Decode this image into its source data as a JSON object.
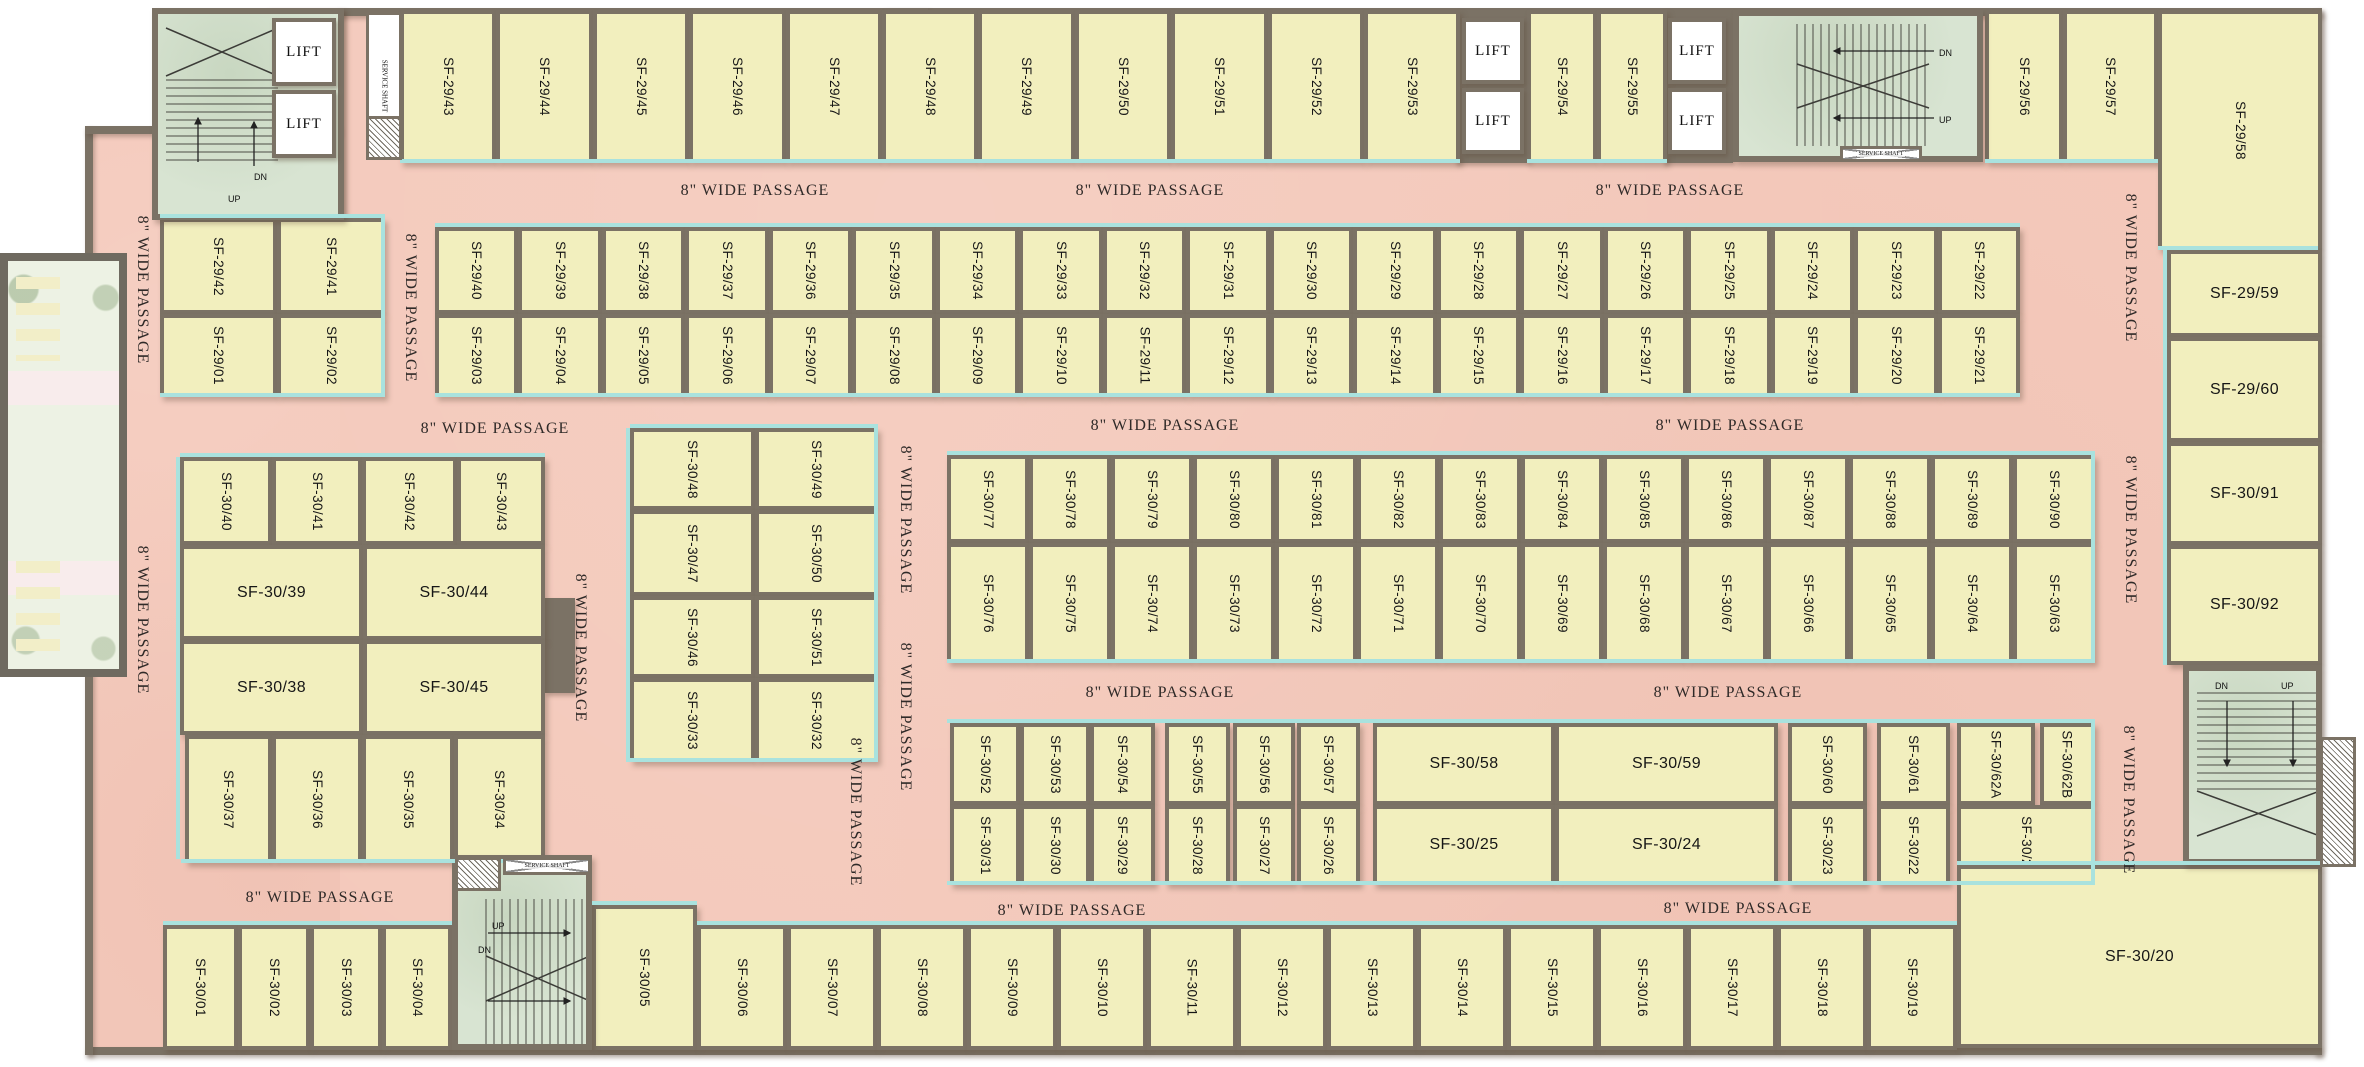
{
  "title": "Second Floor Shop Layout Plan",
  "passage_label": "8\" WIDE PASSAGE",
  "lift_label": "LIFT",
  "stair_up": "UP",
  "stair_dn": "DN",
  "service_shaft_label": "SERVICE SHAFT",
  "fire_shaft_label": "FIRE SHAFT",
  "colors": {
    "wall": "#7b7265",
    "unit_fill": "#f2efbe",
    "passage_fill": "#f4c9bb",
    "storefront": "#a9e2de",
    "stair_fill": "#d8e4d2",
    "label_text": "#161616"
  },
  "lifts": [
    {
      "x": 272,
      "y": 18,
      "w": 64,
      "h": 68
    },
    {
      "x": 272,
      "y": 90,
      "w": 64,
      "h": 68
    },
    {
      "x": 1462,
      "y": 18,
      "w": 62,
      "h": 66
    },
    {
      "x": 1462,
      "y": 88,
      "w": 62,
      "h": 66
    },
    {
      "x": 1668,
      "y": 18,
      "w": 58,
      "h": 66
    },
    {
      "x": 1668,
      "y": 88,
      "w": 58,
      "h": 66
    }
  ],
  "passage_labels": [
    {
      "x": 755,
      "y": 191,
      "o": "h"
    },
    {
      "x": 1150,
      "y": 191,
      "o": "h"
    },
    {
      "x": 1670,
      "y": 191,
      "o": "h"
    },
    {
      "x": 495,
      "y": 429,
      "o": "h"
    },
    {
      "x": 1165,
      "y": 426,
      "o": "h"
    },
    {
      "x": 1730,
      "y": 426,
      "o": "h"
    },
    {
      "x": 1160,
      "y": 693,
      "o": "h"
    },
    {
      "x": 1728,
      "y": 693,
      "o": "h"
    },
    {
      "x": 320,
      "y": 898,
      "o": "h"
    },
    {
      "x": 1072,
      "y": 911,
      "o": "h"
    },
    {
      "x": 1738,
      "y": 909,
      "o": "h"
    },
    {
      "x": 142,
      "y": 290,
      "o": "v"
    },
    {
      "x": 142,
      "y": 620,
      "o": "v"
    },
    {
      "x": 410,
      "y": 308,
      "o": "v"
    },
    {
      "x": 580,
      "y": 648,
      "o": "v"
    },
    {
      "x": 905,
      "y": 520,
      "o": "v"
    },
    {
      "x": 905,
      "y": 717,
      "o": "v"
    },
    {
      "x": 855,
      "y": 812,
      "o": "v"
    },
    {
      "x": 2130,
      "y": 268,
      "o": "v"
    },
    {
      "x": 2130,
      "y": 530,
      "o": "v"
    },
    {
      "x": 2128,
      "y": 800,
      "o": "v"
    }
  ],
  "rooms": [
    {
      "l": "SF-29/43",
      "x": 400,
      "y": 10,
      "w": 96,
      "h": 153,
      "o": "v"
    },
    {
      "l": "SF-29/44",
      "x": 496,
      "y": 10,
      "w": 97,
      "h": 153,
      "o": "v"
    },
    {
      "l": "SF-29/45",
      "x": 593,
      "y": 10,
      "w": 96,
      "h": 153,
      "o": "v"
    },
    {
      "l": "SF-29/46",
      "x": 689,
      "y": 10,
      "w": 97,
      "h": 153,
      "o": "v"
    },
    {
      "l": "SF-29/47",
      "x": 786,
      "y": 10,
      "w": 96,
      "h": 153,
      "o": "v"
    },
    {
      "l": "SF-29/48",
      "x": 882,
      "y": 10,
      "w": 96,
      "h": 153,
      "o": "v"
    },
    {
      "l": "SF-29/49",
      "x": 978,
      "y": 10,
      "w": 97,
      "h": 153,
      "o": "v"
    },
    {
      "l": "SF-29/50",
      "x": 1075,
      "y": 10,
      "w": 96,
      "h": 153,
      "o": "v"
    },
    {
      "l": "SF-29/51",
      "x": 1171,
      "y": 10,
      "w": 97,
      "h": 153,
      "o": "v"
    },
    {
      "l": "SF-29/52",
      "x": 1268,
      "y": 10,
      "w": 96,
      "h": 153,
      "o": "v"
    },
    {
      "l": "SF-29/53",
      "x": 1364,
      "y": 10,
      "w": 96,
      "h": 153,
      "o": "v"
    },
    {
      "l": "SF-29/54",
      "x": 1527,
      "y": 10,
      "w": 70,
      "h": 153,
      "o": "v"
    },
    {
      "l": "SF-29/55",
      "x": 1597,
      "y": 10,
      "w": 70,
      "h": 153,
      "o": "v"
    },
    {
      "l": "SF-29/56",
      "x": 1985,
      "y": 10,
      "w": 78,
      "h": 153,
      "o": "v"
    },
    {
      "l": "SF-29/57",
      "x": 2063,
      "y": 10,
      "w": 95,
      "h": 153,
      "o": "v"
    },
    {
      "l": "SF-29/58",
      "x": 2158,
      "y": 10,
      "w": 164,
      "h": 240,
      "o": "v"
    },
    {
      "l": "SF-29/42",
      "x": 160,
      "y": 218,
      "w": 117,
      "h": 96,
      "o": "v"
    },
    {
      "l": "SF-29/41",
      "x": 277,
      "y": 218,
      "w": 108,
      "h": 96,
      "o": "v"
    },
    {
      "l": "SF-29/01",
      "x": 160,
      "y": 314,
      "w": 117,
      "h": 83,
      "o": "v"
    },
    {
      "l": "SF-29/02",
      "x": 277,
      "y": 314,
      "w": 108,
      "h": 83,
      "o": "v"
    },
    {
      "l": "SF-29/40",
      "x": 435,
      "y": 227,
      "w": 83,
      "h": 87,
      "o": "v"
    },
    {
      "l": "SF-29/39",
      "x": 518,
      "y": 227,
      "w": 84,
      "h": 87,
      "o": "v"
    },
    {
      "l": "SF-29/38",
      "x": 602,
      "y": 227,
      "w": 83,
      "h": 87,
      "o": "v"
    },
    {
      "l": "SF-29/37",
      "x": 685,
      "y": 227,
      "w": 84,
      "h": 87,
      "o": "v"
    },
    {
      "l": "SF-29/36",
      "x": 769,
      "y": 227,
      "w": 83,
      "h": 87,
      "o": "v"
    },
    {
      "l": "SF-29/35",
      "x": 852,
      "y": 227,
      "w": 84,
      "h": 87,
      "o": "v"
    },
    {
      "l": "SF-29/34",
      "x": 936,
      "y": 227,
      "w": 83,
      "h": 87,
      "o": "v"
    },
    {
      "l": "SF-29/33",
      "x": 1019,
      "y": 227,
      "w": 84,
      "h": 87,
      "o": "v"
    },
    {
      "l": "SF-29/32",
      "x": 1103,
      "y": 227,
      "w": 83,
      "h": 87,
      "o": "v"
    },
    {
      "l": "SF-29/31",
      "x": 1186,
      "y": 227,
      "w": 84,
      "h": 87,
      "o": "v"
    },
    {
      "l": "SF-29/30",
      "x": 1270,
      "y": 227,
      "w": 83,
      "h": 87,
      "o": "v"
    },
    {
      "l": "SF-29/29",
      "x": 1353,
      "y": 227,
      "w": 84,
      "h": 87,
      "o": "v"
    },
    {
      "l": "SF-29/28",
      "x": 1437,
      "y": 227,
      "w": 83,
      "h": 87,
      "o": "v"
    },
    {
      "l": "SF-29/27",
      "x": 1520,
      "y": 227,
      "w": 84,
      "h": 87,
      "o": "v"
    },
    {
      "l": "SF-29/26",
      "x": 1604,
      "y": 227,
      "w": 83,
      "h": 87,
      "o": "v"
    },
    {
      "l": "SF-29/25",
      "x": 1687,
      "y": 227,
      "w": 84,
      "h": 87,
      "o": "v"
    },
    {
      "l": "SF-29/24",
      "x": 1771,
      "y": 227,
      "w": 83,
      "h": 87,
      "o": "v"
    },
    {
      "l": "SF-29/23",
      "x": 1854,
      "y": 227,
      "w": 84,
      "h": 87,
      "o": "v"
    },
    {
      "l": "SF-29/22",
      "x": 1938,
      "y": 227,
      "w": 82,
      "h": 87,
      "o": "v"
    },
    {
      "l": "SF-29/03",
      "x": 435,
      "y": 314,
      "w": 83,
      "h": 83,
      "o": "v"
    },
    {
      "l": "SF-29/04",
      "x": 518,
      "y": 314,
      "w": 84,
      "h": 83,
      "o": "v"
    },
    {
      "l": "SF-29/05",
      "x": 602,
      "y": 314,
      "w": 83,
      "h": 83,
      "o": "v"
    },
    {
      "l": "SF-29/06",
      "x": 685,
      "y": 314,
      "w": 84,
      "h": 83,
      "o": "v"
    },
    {
      "l": "SF-29/07",
      "x": 769,
      "y": 314,
      "w": 83,
      "h": 83,
      "o": "v"
    },
    {
      "l": "SF-29/08",
      "x": 852,
      "y": 314,
      "w": 84,
      "h": 83,
      "o": "v"
    },
    {
      "l": "SF-29/09",
      "x": 936,
      "y": 314,
      "w": 83,
      "h": 83,
      "o": "v"
    },
    {
      "l": "SF-29/10",
      "x": 1019,
      "y": 314,
      "w": 84,
      "h": 83,
      "o": "v"
    },
    {
      "l": "SF-29/11",
      "x": 1103,
      "y": 314,
      "w": 83,
      "h": 83,
      "o": "v"
    },
    {
      "l": "SF-29/12",
      "x": 1186,
      "y": 314,
      "w": 84,
      "h": 83,
      "o": "v"
    },
    {
      "l": "SF-29/13",
      "x": 1270,
      "y": 314,
      "w": 83,
      "h": 83,
      "o": "v"
    },
    {
      "l": "SF-29/14",
      "x": 1353,
      "y": 314,
      "w": 84,
      "h": 83,
      "o": "v"
    },
    {
      "l": "SF-29/15",
      "x": 1437,
      "y": 314,
      "w": 83,
      "h": 83,
      "o": "v"
    },
    {
      "l": "SF-29/16",
      "x": 1520,
      "y": 314,
      "w": 84,
      "h": 83,
      "o": "v"
    },
    {
      "l": "SF-29/17",
      "x": 1604,
      "y": 314,
      "w": 83,
      "h": 83,
      "o": "v"
    },
    {
      "l": "SF-29/18",
      "x": 1687,
      "y": 314,
      "w": 84,
      "h": 83,
      "o": "v"
    },
    {
      "l": "SF-29/19",
      "x": 1771,
      "y": 314,
      "w": 83,
      "h": 83,
      "o": "v"
    },
    {
      "l": "SF-29/20",
      "x": 1854,
      "y": 314,
      "w": 84,
      "h": 83,
      "o": "v"
    },
    {
      "l": "SF-29/21",
      "x": 1938,
      "y": 314,
      "w": 82,
      "h": 83,
      "o": "v"
    },
    {
      "l": "SF-29/59",
      "x": 2167,
      "y": 250,
      "w": 155,
      "h": 87,
      "o": "h"
    },
    {
      "l": "SF-29/60",
      "x": 2167,
      "y": 337,
      "w": 155,
      "h": 105,
      "o": "h"
    },
    {
      "l": "SF-30/91",
      "x": 2167,
      "y": 442,
      "w": 155,
      "h": 103,
      "o": "h"
    },
    {
      "l": "SF-30/92",
      "x": 2167,
      "y": 545,
      "w": 155,
      "h": 120,
      "o": "h"
    },
    {
      "l": "SF-30/40",
      "x": 180,
      "y": 457,
      "w": 92,
      "h": 88,
      "o": "v"
    },
    {
      "l": "SF-30/41",
      "x": 272,
      "y": 457,
      "w": 90,
      "h": 88,
      "o": "v"
    },
    {
      "l": "SF-30/42",
      "x": 362,
      "y": 457,
      "w": 95,
      "h": 88,
      "o": "v"
    },
    {
      "l": "SF-30/43",
      "x": 457,
      "y": 457,
      "w": 88,
      "h": 88,
      "o": "v"
    },
    {
      "l": "SF-30/39",
      "x": 180,
      "y": 545,
      "w": 183,
      "h": 95,
      "o": "h"
    },
    {
      "l": "SF-30/44",
      "x": 363,
      "y": 545,
      "w": 182,
      "h": 95,
      "o": "h"
    },
    {
      "l": "SF-30/38",
      "x": 180,
      "y": 640,
      "w": 183,
      "h": 95,
      "o": "h"
    },
    {
      "l": "SF-30/45",
      "x": 363,
      "y": 640,
      "w": 182,
      "h": 95,
      "o": "h"
    },
    {
      "l": "SF-30/37",
      "x": 185,
      "y": 735,
      "w": 87,
      "h": 128,
      "o": "v"
    },
    {
      "l": "SF-30/36",
      "x": 272,
      "y": 735,
      "w": 90,
      "h": 128,
      "o": "v"
    },
    {
      "l": "SF-30/35",
      "x": 362,
      "y": 735,
      "w": 92,
      "h": 128,
      "o": "v"
    },
    {
      "l": "SF-30/34",
      "x": 454,
      "y": 735,
      "w": 91,
      "h": 128,
      "o": "v"
    },
    {
      "l": "SF-30/48",
      "x": 630,
      "y": 428,
      "w": 125,
      "h": 82,
      "o": "v"
    },
    {
      "l": "SF-30/49",
      "x": 755,
      "y": 428,
      "w": 123,
      "h": 82,
      "o": "v"
    },
    {
      "l": "SF-30/47",
      "x": 630,
      "y": 510,
      "w": 125,
      "h": 86,
      "o": "v"
    },
    {
      "l": "SF-30/50",
      "x": 755,
      "y": 510,
      "w": 123,
      "h": 86,
      "o": "v"
    },
    {
      "l": "SF-30/46",
      "x": 630,
      "y": 596,
      "w": 125,
      "h": 82,
      "o": "v"
    },
    {
      "l": "SF-30/51",
      "x": 755,
      "y": 596,
      "w": 123,
      "h": 82,
      "o": "v"
    },
    {
      "l": "SF-30/33",
      "x": 630,
      "y": 678,
      "w": 125,
      "h": 84,
      "o": "v"
    },
    {
      "l": "SF-30/32",
      "x": 755,
      "y": 678,
      "w": 123,
      "h": 84,
      "o": "v"
    },
    {
      "l": "SF-30/77",
      "x": 947,
      "y": 455,
      "w": 82,
      "h": 88,
      "o": "v"
    },
    {
      "l": "SF-30/78",
      "x": 1029,
      "y": 455,
      "w": 82,
      "h": 88,
      "o": "v"
    },
    {
      "l": "SF-30/79",
      "x": 1111,
      "y": 455,
      "w": 82,
      "h": 88,
      "o": "v"
    },
    {
      "l": "SF-30/80",
      "x": 1193,
      "y": 455,
      "w": 82,
      "h": 88,
      "o": "v"
    },
    {
      "l": "SF-30/81",
      "x": 1275,
      "y": 455,
      "w": 82,
      "h": 88,
      "o": "v"
    },
    {
      "l": "SF-30/82",
      "x": 1357,
      "y": 455,
      "w": 82,
      "h": 88,
      "o": "v"
    },
    {
      "l": "SF-30/83",
      "x": 1439,
      "y": 455,
      "w": 82,
      "h": 88,
      "o": "v"
    },
    {
      "l": "SF-30/84",
      "x": 1521,
      "y": 455,
      "w": 82,
      "h": 88,
      "o": "v"
    },
    {
      "l": "SF-30/85",
      "x": 1603,
      "y": 455,
      "w": 82,
      "h": 88,
      "o": "v"
    },
    {
      "l": "SF-30/86",
      "x": 1685,
      "y": 455,
      "w": 82,
      "h": 88,
      "o": "v"
    },
    {
      "l": "SF-30/87",
      "x": 1767,
      "y": 455,
      "w": 82,
      "h": 88,
      "o": "v"
    },
    {
      "l": "SF-30/88",
      "x": 1849,
      "y": 455,
      "w": 82,
      "h": 88,
      "o": "v"
    },
    {
      "l": "SF-30/89",
      "x": 1931,
      "y": 455,
      "w": 82,
      "h": 88,
      "o": "v"
    },
    {
      "l": "SF-30/90",
      "x": 2013,
      "y": 455,
      "w": 82,
      "h": 88,
      "o": "v"
    },
    {
      "l": "SF-30/76",
      "x": 947,
      "y": 543,
      "w": 82,
      "h": 120,
      "o": "v"
    },
    {
      "l": "SF-30/75",
      "x": 1029,
      "y": 543,
      "w": 82,
      "h": 120,
      "o": "v"
    },
    {
      "l": "SF-30/74",
      "x": 1111,
      "y": 543,
      "w": 82,
      "h": 120,
      "o": "v"
    },
    {
      "l": "SF-30/73",
      "x": 1193,
      "y": 543,
      "w": 82,
      "h": 120,
      "o": "v"
    },
    {
      "l": "SF-30/72",
      "x": 1275,
      "y": 543,
      "w": 82,
      "h": 120,
      "o": "v"
    },
    {
      "l": "SF-30/71",
      "x": 1357,
      "y": 543,
      "w": 82,
      "h": 120,
      "o": "v"
    },
    {
      "l": "SF-30/70",
      "x": 1439,
      "y": 543,
      "w": 82,
      "h": 120,
      "o": "v"
    },
    {
      "l": "SF-30/69",
      "x": 1521,
      "y": 543,
      "w": 82,
      "h": 120,
      "o": "v"
    },
    {
      "l": "SF-30/68",
      "x": 1603,
      "y": 543,
      "w": 82,
      "h": 120,
      "o": "v"
    },
    {
      "l": "SF-30/67",
      "x": 1685,
      "y": 543,
      "w": 82,
      "h": 120,
      "o": "v"
    },
    {
      "l": "SF-30/66",
      "x": 1767,
      "y": 543,
      "w": 82,
      "h": 120,
      "o": "v"
    },
    {
      "l": "SF-30/65",
      "x": 1849,
      "y": 543,
      "w": 82,
      "h": 120,
      "o": "v"
    },
    {
      "l": "SF-30/64",
      "x": 1931,
      "y": 543,
      "w": 82,
      "h": 120,
      "o": "v"
    },
    {
      "l": "SF-30/63",
      "x": 2013,
      "y": 543,
      "w": 82,
      "h": 120,
      "o": "v"
    },
    {
      "l": "SF-30/52",
      "x": 950,
      "y": 723,
      "w": 70,
      "h": 82,
      "o": "v"
    },
    {
      "l": "SF-30/53",
      "x": 1020,
      "y": 723,
      "w": 70,
      "h": 82,
      "o": "v"
    },
    {
      "l": "SF-30/54",
      "x": 1090,
      "y": 723,
      "w": 65,
      "h": 82,
      "o": "v"
    },
    {
      "l": "SF-30/55",
      "x": 1165,
      "y": 723,
      "w": 65,
      "h": 82,
      "o": "v"
    },
    {
      "l": "SF-30/56",
      "x": 1233,
      "y": 723,
      "w": 62,
      "h": 82,
      "o": "v"
    },
    {
      "l": "SF-30/57",
      "x": 1297,
      "y": 723,
      "w": 63,
      "h": 82,
      "o": "v"
    },
    {
      "l": "SF-30/58",
      "x": 1373,
      "y": 723,
      "w": 182,
      "h": 82,
      "o": "h"
    },
    {
      "l": "SF-30/59",
      "x": 1555,
      "y": 723,
      "w": 223,
      "h": 82,
      "o": "h"
    },
    {
      "l": "SF-30/60",
      "x": 1788,
      "y": 723,
      "w": 79,
      "h": 82,
      "o": "v"
    },
    {
      "l": "SF-30/61",
      "x": 1877,
      "y": 723,
      "w": 73,
      "h": 82,
      "o": "v"
    },
    {
      "l": "SF-30/62A",
      "x": 1957,
      "y": 723,
      "w": 78,
      "h": 82,
      "o": "v"
    },
    {
      "l": "SF-30/62B",
      "x": 2040,
      "y": 723,
      "w": 55,
      "h": 82,
      "o": "v"
    },
    {
      "l": "SF-30/31",
      "x": 950,
      "y": 805,
      "w": 70,
      "h": 80,
      "o": "v"
    },
    {
      "l": "SF-30/30",
      "x": 1020,
      "y": 805,
      "w": 70,
      "h": 80,
      "o": "v"
    },
    {
      "l": "SF-30/29",
      "x": 1090,
      "y": 805,
      "w": 65,
      "h": 80,
      "o": "v"
    },
    {
      "l": "SF-30/28",
      "x": 1165,
      "y": 805,
      "w": 65,
      "h": 80,
      "o": "v"
    },
    {
      "l": "SF-30/27",
      "x": 1233,
      "y": 805,
      "w": 62,
      "h": 80,
      "o": "v"
    },
    {
      "l": "SF-30/26",
      "x": 1297,
      "y": 805,
      "w": 63,
      "h": 80,
      "o": "v"
    },
    {
      "l": "SF-30/25",
      "x": 1373,
      "y": 805,
      "w": 182,
      "h": 80,
      "o": "h"
    },
    {
      "l": "SF-30/24",
      "x": 1555,
      "y": 805,
      "w": 223,
      "h": 80,
      "o": "h"
    },
    {
      "l": "SF-30/23",
      "x": 1788,
      "y": 805,
      "w": 79,
      "h": 80,
      "o": "v"
    },
    {
      "l": "SF-30/22",
      "x": 1877,
      "y": 805,
      "w": 73,
      "h": 80,
      "o": "v"
    },
    {
      "l": "SF-30/21",
      "x": 1957,
      "y": 805,
      "w": 138,
      "h": 80,
      "o": "v"
    },
    {
      "l": "SF-30/01",
      "x": 163,
      "y": 925,
      "w": 75,
      "h": 125,
      "o": "v"
    },
    {
      "l": "SF-30/02",
      "x": 238,
      "y": 925,
      "w": 72,
      "h": 125,
      "o": "v"
    },
    {
      "l": "SF-30/03",
      "x": 310,
      "y": 925,
      "w": 72,
      "h": 125,
      "o": "v"
    },
    {
      "l": "SF-30/04",
      "x": 382,
      "y": 925,
      "w": 70,
      "h": 125,
      "o": "v"
    },
    {
      "l": "SF-30/05",
      "x": 592,
      "y": 905,
      "w": 105,
      "h": 145,
      "o": "v"
    },
    {
      "l": "SF-30/06",
      "x": 697,
      "y": 925,
      "w": 90,
      "h": 125,
      "o": "v"
    },
    {
      "l": "SF-30/07",
      "x": 787,
      "y": 925,
      "w": 90,
      "h": 125,
      "o": "v"
    },
    {
      "l": "SF-30/08",
      "x": 877,
      "y": 925,
      "w": 90,
      "h": 125,
      "o": "v"
    },
    {
      "l": "SF-30/09",
      "x": 967,
      "y": 925,
      "w": 90,
      "h": 125,
      "o": "v"
    },
    {
      "l": "SF-30/10",
      "x": 1057,
      "y": 925,
      "w": 90,
      "h": 125,
      "o": "v"
    },
    {
      "l": "SF-30/11",
      "x": 1147,
      "y": 925,
      "w": 90,
      "h": 125,
      "o": "v"
    },
    {
      "l": "SF-30/12",
      "x": 1237,
      "y": 925,
      "w": 90,
      "h": 125,
      "o": "v"
    },
    {
      "l": "SF-30/13",
      "x": 1327,
      "y": 925,
      "w": 90,
      "h": 125,
      "o": "v"
    },
    {
      "l": "SF-30/14",
      "x": 1417,
      "y": 925,
      "w": 90,
      "h": 125,
      "o": "v"
    },
    {
      "l": "SF-30/15",
      "x": 1507,
      "y": 925,
      "w": 90,
      "h": 125,
      "o": "v"
    },
    {
      "l": "SF-30/16",
      "x": 1597,
      "y": 925,
      "w": 90,
      "h": 125,
      "o": "v"
    },
    {
      "l": "SF-30/17",
      "x": 1687,
      "y": 925,
      "w": 90,
      "h": 125,
      "o": "v"
    },
    {
      "l": "SF-30/18",
      "x": 1777,
      "y": 925,
      "w": 90,
      "h": 125,
      "o": "v"
    },
    {
      "l": "SF-30/19",
      "x": 1867,
      "y": 925,
      "w": 90,
      "h": 125,
      "o": "v"
    },
    {
      "l": "SF-30/20",
      "x": 1957,
      "y": 865,
      "w": 365,
      "h": 183,
      "o": "h"
    }
  ]
}
